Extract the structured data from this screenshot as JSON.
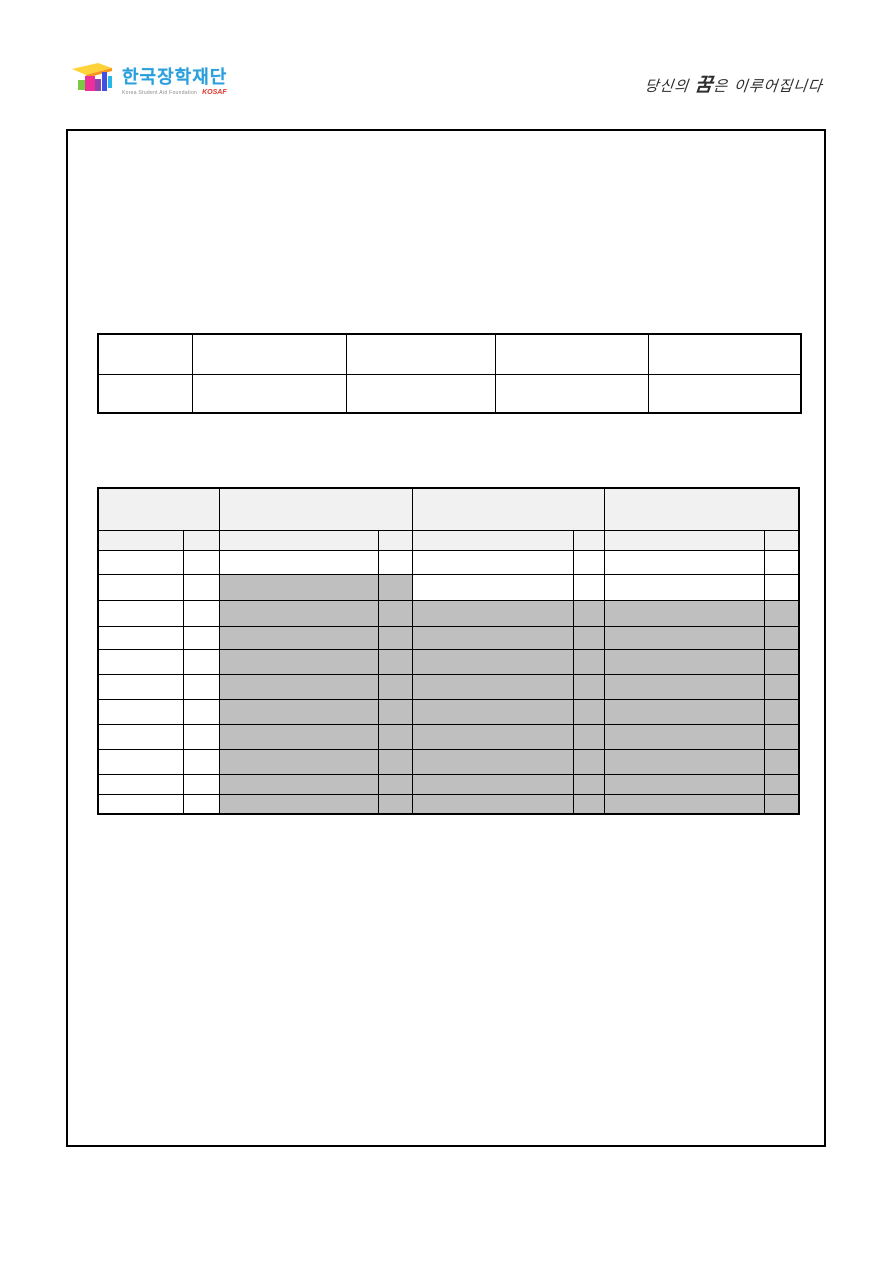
{
  "logo": {
    "icon": "graduation-cap-icon",
    "brand": "한국장학재단",
    "subtitle": "Korea Student Aid Foundation",
    "acronym": "KOSAF",
    "brand_color": "#2a9fdc",
    "acronym_color": "#e0352b"
  },
  "slogan": {
    "prefix": "당신의 ",
    "emphasis": "꿈",
    "suffix": "은 이루어집니다",
    "color": "#2e2e2e"
  },
  "colors": {
    "page_background": "#ffffff",
    "frame_border": "#000000",
    "table_border": "#000000",
    "header_fill": "#f1f1f1",
    "shaded_fill": "#bfbfbf",
    "cell_fill": "#ffffff"
  },
  "table1": {
    "col_widths_px": [
      94,
      154,
      149,
      153,
      153
    ],
    "row_heights_px": [
      40,
      39
    ],
    "rows": [
      [
        "",
        "",
        "",
        "",
        ""
      ],
      [
        "",
        "",
        "",
        "",
        ""
      ]
    ]
  },
  "table2": {
    "col_widths_px": [
      85,
      36,
      159,
      34,
      161,
      31,
      160,
      35
    ],
    "header_row1": {
      "height_px": 42,
      "colspans": [
        2,
        2,
        2,
        2
      ],
      "cells": [
        "",
        "",
        "",
        ""
      ]
    },
    "header_row2": {
      "height_px": 20,
      "cells": [
        "",
        "",
        "",
        "",
        "",
        "",
        "",
        ""
      ]
    },
    "data_rows": [
      {
        "height_px": 24,
        "cells": [
          "",
          "",
          "",
          "",
          "",
          "",
          "",
          ""
        ],
        "shaded_cols": []
      },
      {
        "height_px": 26,
        "cells": [
          "",
          "",
          "",
          "",
          "",
          "",
          "",
          ""
        ],
        "shaded_cols": [
          2,
          3
        ]
      },
      {
        "height_px": 26,
        "cells": [
          "",
          "",
          "",
          "",
          "",
          "",
          "",
          ""
        ],
        "shaded_cols": [
          2,
          3,
          4,
          5,
          6,
          7
        ]
      },
      {
        "height_px": 23,
        "cells": [
          "",
          "",
          "",
          "",
          "",
          "",
          "",
          ""
        ],
        "shaded_cols": [
          2,
          3,
          4,
          5,
          6,
          7
        ]
      },
      {
        "height_px": 25,
        "cells": [
          "",
          "",
          "",
          "",
          "",
          "",
          "",
          ""
        ],
        "shaded_cols": [
          2,
          3,
          4,
          5,
          6,
          7
        ]
      },
      {
        "height_px": 25,
        "cells": [
          "",
          "",
          "",
          "",
          "",
          "",
          "",
          ""
        ],
        "shaded_cols": [
          2,
          3,
          4,
          5,
          6,
          7
        ]
      },
      {
        "height_px": 25,
        "cells": [
          "",
          "",
          "",
          "",
          "",
          "",
          "",
          ""
        ],
        "shaded_cols": [
          2,
          3,
          4,
          5,
          6,
          7
        ]
      },
      {
        "height_px": 25,
        "cells": [
          "",
          "",
          "",
          "",
          "",
          "",
          "",
          ""
        ],
        "shaded_cols": [
          2,
          3,
          4,
          5,
          6,
          7
        ]
      },
      {
        "height_px": 25,
        "cells": [
          "",
          "",
          "",
          "",
          "",
          "",
          "",
          ""
        ],
        "shaded_cols": [
          2,
          3,
          4,
          5,
          6,
          7
        ]
      },
      {
        "height_px": 20,
        "cells": [
          "",
          "",
          "",
          "",
          "",
          "",
          "",
          ""
        ],
        "shaded_cols": [
          2,
          3,
          4,
          5,
          6,
          7
        ]
      },
      {
        "height_px": 20,
        "cells": [
          "",
          "",
          "",
          "",
          "",
          "",
          "",
          ""
        ],
        "shaded_cols": [
          2,
          3,
          4,
          5,
          6,
          7
        ]
      }
    ]
  }
}
